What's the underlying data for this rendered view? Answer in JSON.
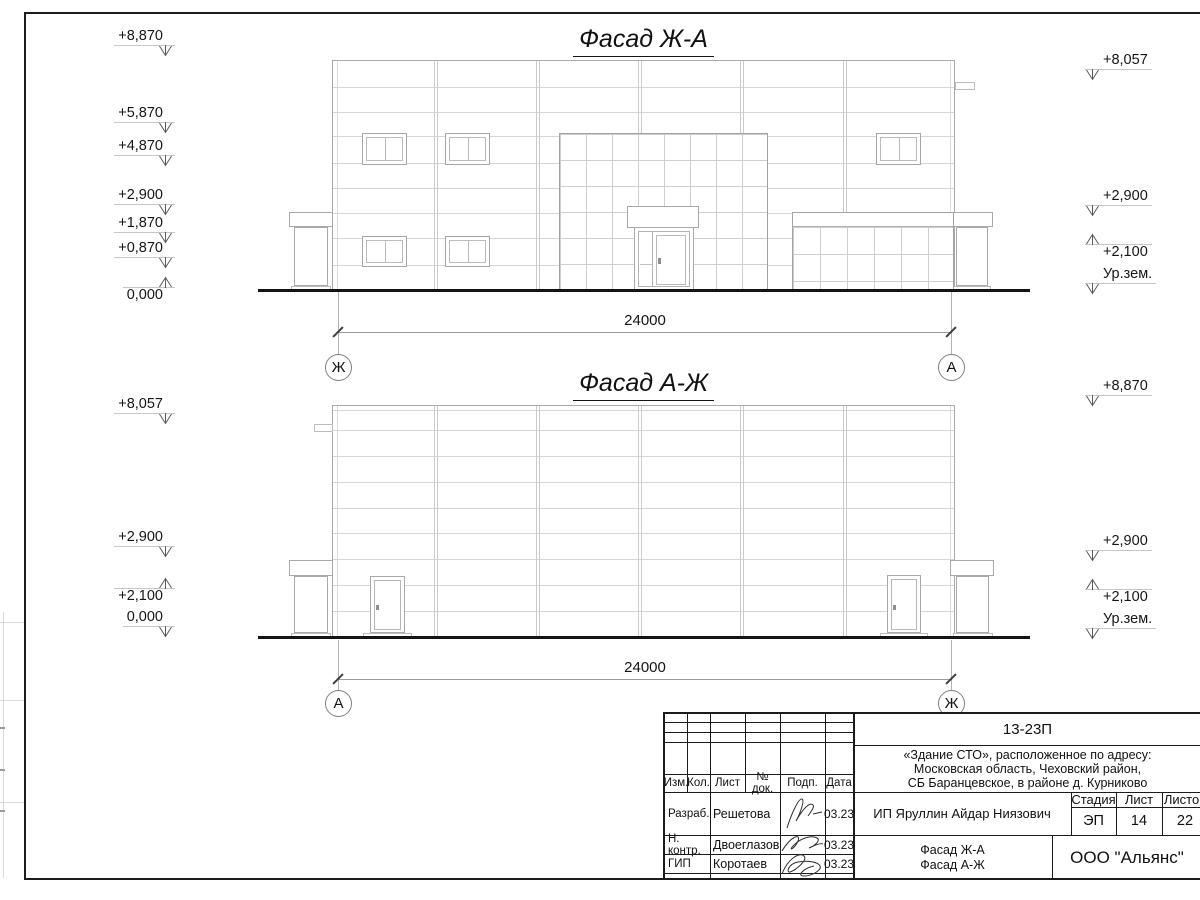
{
  "colors": {
    "ink": "#1a1a1a",
    "drawing_line": "#c8c8c8",
    "background": "#ffffff"
  },
  "facades": [
    {
      "title": "Фасад Ж-А",
      "dimension": "24000",
      "axis_left": "Ж",
      "axis_right": "А",
      "levels_left": [
        "+8,870",
        "+5,870",
        "+4,870",
        "+2,900",
        "+1,870",
        "+0,870",
        "0,000"
      ],
      "levels_right": [
        "+8,057",
        "+2,900",
        "+2,100",
        "Ур.зем."
      ]
    },
    {
      "title": "Фасад А-Ж",
      "dimension": "24000",
      "axis_left": "А",
      "axis_right": "Ж",
      "levels_left": [
        "+8,057",
        "+2,900",
        "+2,100",
        "0,000"
      ],
      "levels_right": [
        "+8,870",
        "+2,900",
        "+2,100",
        "Ур.зем."
      ]
    }
  ],
  "titleblock": {
    "doc_number": "13-23П",
    "project_line1": "«Здание СТО», расположенное по адресу:",
    "project_line2": "Московская область, Чеховский район,",
    "project_line3": "СБ Баранцевское, в районе д. Курниково",
    "col_izm": "Изм.",
    "col_kol": "Кол.",
    "col_list": "Лист",
    "col_ndok": "№ док.",
    "col_podp": "Подп.",
    "col_data": "Дата",
    "rows": [
      {
        "role": "Разраб.",
        "name": "Решетова",
        "date": "03.23"
      },
      {
        "role": "Н. контр.",
        "name": "Двоеглазов",
        "date": "03.23"
      },
      {
        "role": "ГИП",
        "name": "Коротаев",
        "date": "03.23"
      }
    ],
    "client": "ИП Яруллин Айдар Ниязович",
    "stage_label": "Стадия",
    "sheet_label": "Лист",
    "sheets_label": "Листов",
    "stage": "ЭП",
    "sheet": "14",
    "sheets": "22",
    "sheet_title_line1": "Фасад Ж-А",
    "sheet_title_line2": "Фасад А-Ж",
    "organization": "ООО \"Альянс\""
  }
}
